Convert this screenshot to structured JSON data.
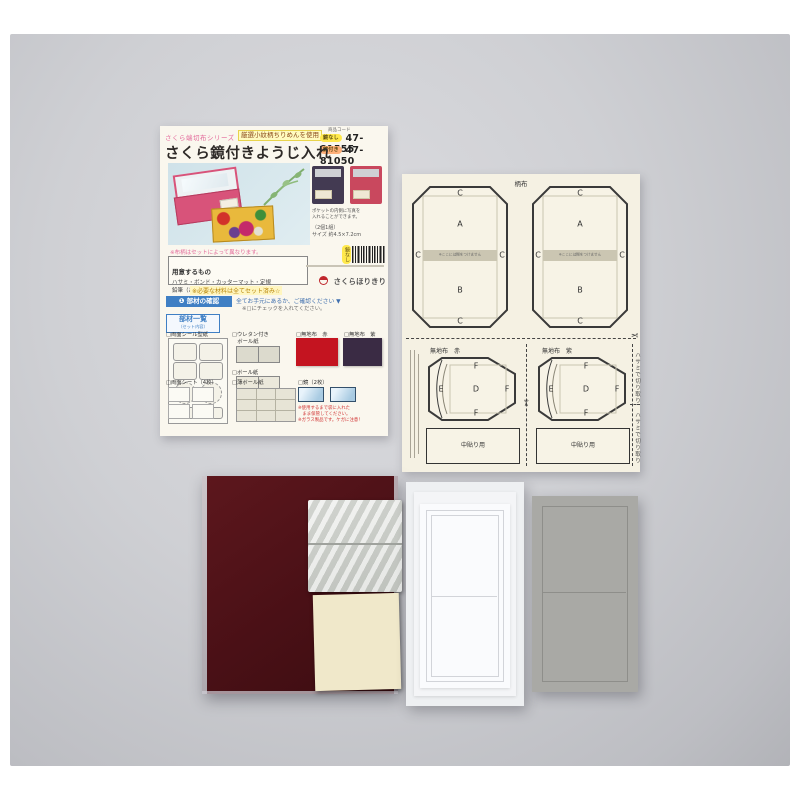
{
  "instruction_sheet": {
    "series": "さくら端切布シリーズ",
    "highlight": "厳選小紋柄ちりめんを使用",
    "title": "さくら鏡付きようじ入れ",
    "product_code_label": "商品コード",
    "code_rows": [
      {
        "badge": "鏡なし",
        "code": "47-81555"
      },
      {
        "badge": "鏡付き",
        "code": "47-81050"
      }
    ],
    "variant_note1": "ポケットの内側に写真を",
    "variant_note2": "入れることができます。",
    "size_note1": "（2個1組）",
    "size_note2": "サイズ 約4.5×7.2cm",
    "fabric_note": "※布柄はセットによって異なります。",
    "tools_label": "用意するもの",
    "tools_line1": "ハサミ・ボンド・カッターマット・定規",
    "tools_line2": "鉛筆（あると便利）など",
    "set_note": "※必要な材料は全てセット済み☆",
    "barcode_badge": "鏡なし",
    "brand": "さくらほりきり",
    "step1": {
      "step_label": "❶ 部材の確認",
      "check_text1": "全てお手元にあるか、ご確認ください ▼",
      "check_text2": "※□にチェックを入れてください。",
      "parts_list_title": "部材一覧",
      "parts_list_sub": "（セット内容）"
    },
    "parts": {
      "p1": "□両面シール型紙",
      "p2a": "□ウレタン付き",
      "p2b": "　ボール紙",
      "p3": "□ボール紙",
      "p4": "□無地布　赤",
      "p5": "□無地布　紫",
      "p6": "□両面シート（4枚）",
      "p7": "□薄ボール紙",
      "p8": "□鏡（2枚）",
      "warn1": "※使用するまで袋に入れた",
      "warn2": "　まま保管してください。",
      "warn3": "※ガラス製品です。ケガに注意！"
    }
  },
  "pattern_sheet": {
    "top_label": "柄布",
    "strip_note": "※ここには糊をつけません",
    "letters": {
      "A": "A",
      "B": "B",
      "C": "C",
      "D": "D",
      "E": "E",
      "F": "F"
    },
    "section_red": "無地布　赤",
    "section_purple": "無地布　紫",
    "paste_label": "中貼り用",
    "cut_note": "ハサミで切り取り",
    "scissors": "✂"
  },
  "colors": {
    "red_fabric": "#c41420",
    "purple_fabric": "#3a2b44",
    "maroon_fabric_pack": "#4a1016",
    "mirror_blue": "#a9cbe2",
    "accent_blue": "#3f7fc4",
    "brand_red": "#c0272d"
  }
}
